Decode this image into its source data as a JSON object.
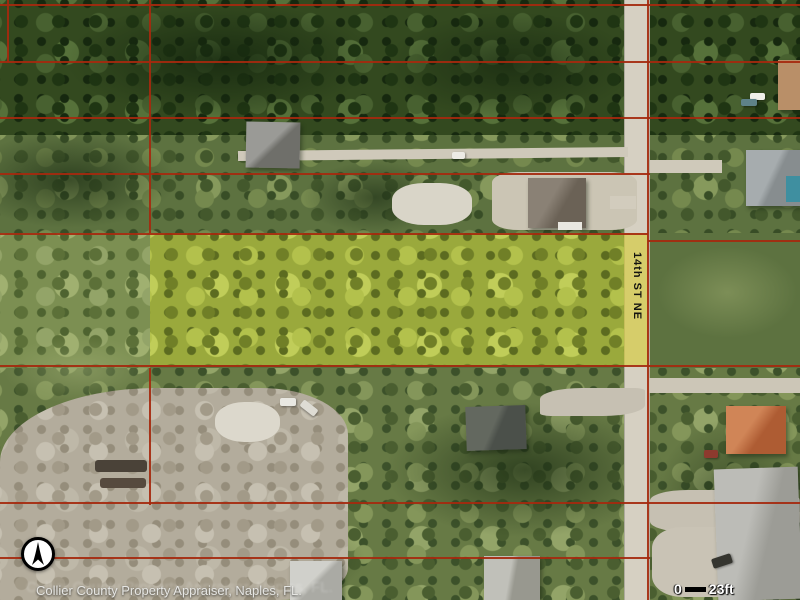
{
  "map": {
    "type": "aerial-parcel-map",
    "street_label": "14th ST NE",
    "attribution": "Collier County Property Appraiser, Naples, FL.",
    "scale_bar": {
      "start_label": "0",
      "end_label": "23ft"
    },
    "colors": {
      "parcel_line": "#a5290e",
      "highlight_parcel": "#9aa93c",
      "road": "#d6d0c2"
    },
    "icons": {
      "north_arrow": "north-arrow-icon"
    }
  }
}
